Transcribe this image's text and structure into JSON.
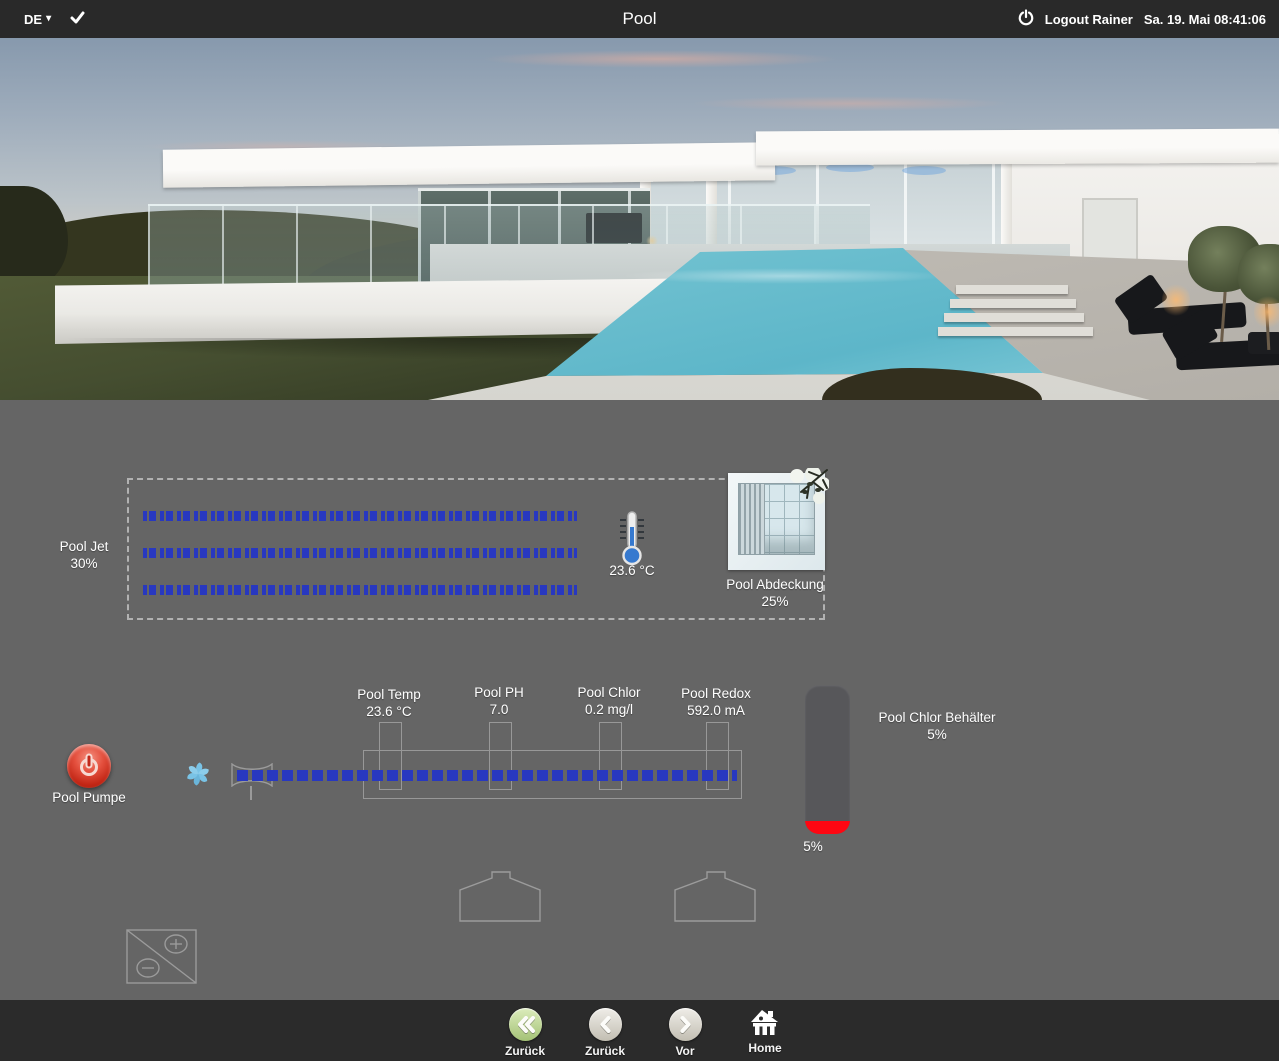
{
  "topbar": {
    "language": "DE",
    "caret_glyph": "▾",
    "check_glyph": "✓",
    "title": "Pool",
    "logout_label": "Logout Rainer",
    "datetime": "Sa. 19. Mai 08:41:06"
  },
  "pool_jet": {
    "label": "Pool Jet",
    "value": "30%"
  },
  "water_temp": {
    "value": "23.6 °C"
  },
  "pool_cover": {
    "label": "Pool Abdeckung",
    "value": "25%"
  },
  "pool_pump": {
    "label": "Pool Pumpe"
  },
  "sensors": [
    {
      "label": "Pool Temp",
      "value": "23.6 °C"
    },
    {
      "label": "Pool PH",
      "value": "7.0"
    },
    {
      "label": "Pool Chlor",
      "value": "0.2 mg/l"
    },
    {
      "label": "Pool Redox",
      "value": "592.0 mA"
    }
  ],
  "chlor_tank": {
    "label": "Pool Chlor Behälter",
    "value": "5%",
    "level_label": "5%",
    "level_percent": 5
  },
  "nav": [
    {
      "label": "Zurück",
      "icon": "double-chevron-left-icon"
    },
    {
      "label": "Zurück",
      "icon": "chevron-left-icon"
    },
    {
      "label": "Vor",
      "icon": "chevron-right-icon"
    },
    {
      "label": "Home",
      "icon": "home-icon"
    }
  ],
  "colors": {
    "flow_blue": "#2838c0",
    "tank_fill_red": "#fe0712",
    "panel_gray": "#656565",
    "topbar_dark": "#292929",
    "footer_dark": "#2b2b2b",
    "nav_green": "#a4c276"
  }
}
